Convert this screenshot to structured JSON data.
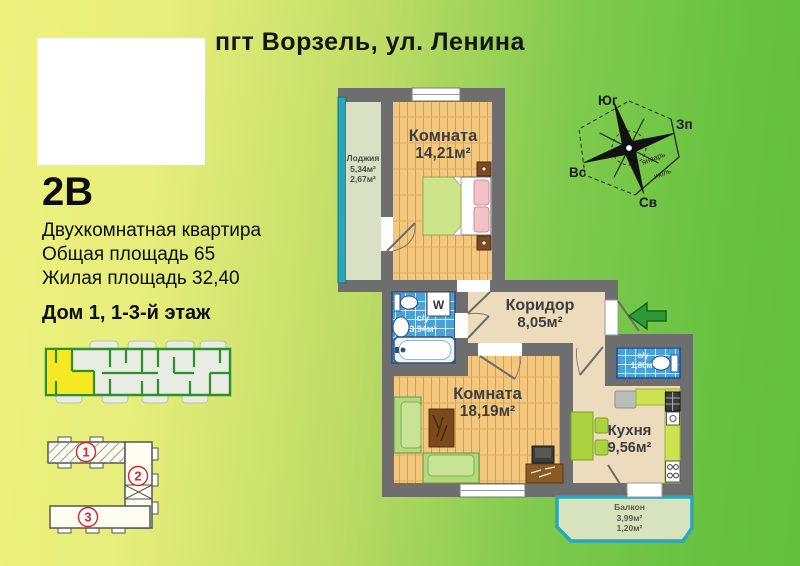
{
  "header": {
    "title": "пгт  Ворзель, ул. Ленина"
  },
  "apartment": {
    "code": "2В",
    "type": "Двухкомнатная квартира",
    "total_area": "Общая площадь 65",
    "living_area": "Жилая площадь 32,40",
    "house": "Дом 1, 1-3-й этаж"
  },
  "compass": {
    "south": "Юг",
    "west": "Зп",
    "east": "Вс",
    "northeast": "Св",
    "january": "январь",
    "july": "июль"
  },
  "rooms": {
    "bedroom": {
      "name": "Комната",
      "area": "14,21м²"
    },
    "loggia": {
      "name": "Лоджия",
      "area1": "5,34м²",
      "area2": "2,67м²"
    },
    "corridor": {
      "name": "Коридор",
      "area": "8,05м²"
    },
    "bathroom": {
      "name": "с/у",
      "area": "3,94м²",
      "washer": "W"
    },
    "living": {
      "name": "Комната",
      "area": "18,19м²"
    },
    "kitchen": {
      "name": "Кухня",
      "area": "9,56м²"
    },
    "wc": {
      "name": "с/у",
      "area": "1,80м²"
    },
    "balcony": {
      "name": "Балкон",
      "area1": "3,99м²",
      "area2": "1,20м²"
    }
  },
  "site_plan": {
    "building1": "1",
    "building2": "2",
    "building3": "3"
  },
  "colors": {
    "wall": "#6e6e6e",
    "wood_floor": "#f3c87e",
    "hall_floor": "#ecdbbd",
    "tile_blue": "#4aa0d8",
    "loggia_floor": "#d9e0c3",
    "glazing_teal": "#2aa5ba",
    "arrow_green": "#2e9a36",
    "highlight_yellow": "#f6e823",
    "badge_red": "#cc2a2a",
    "bg_left": "#eef17e",
    "bg_right": "#63bf3c"
  }
}
